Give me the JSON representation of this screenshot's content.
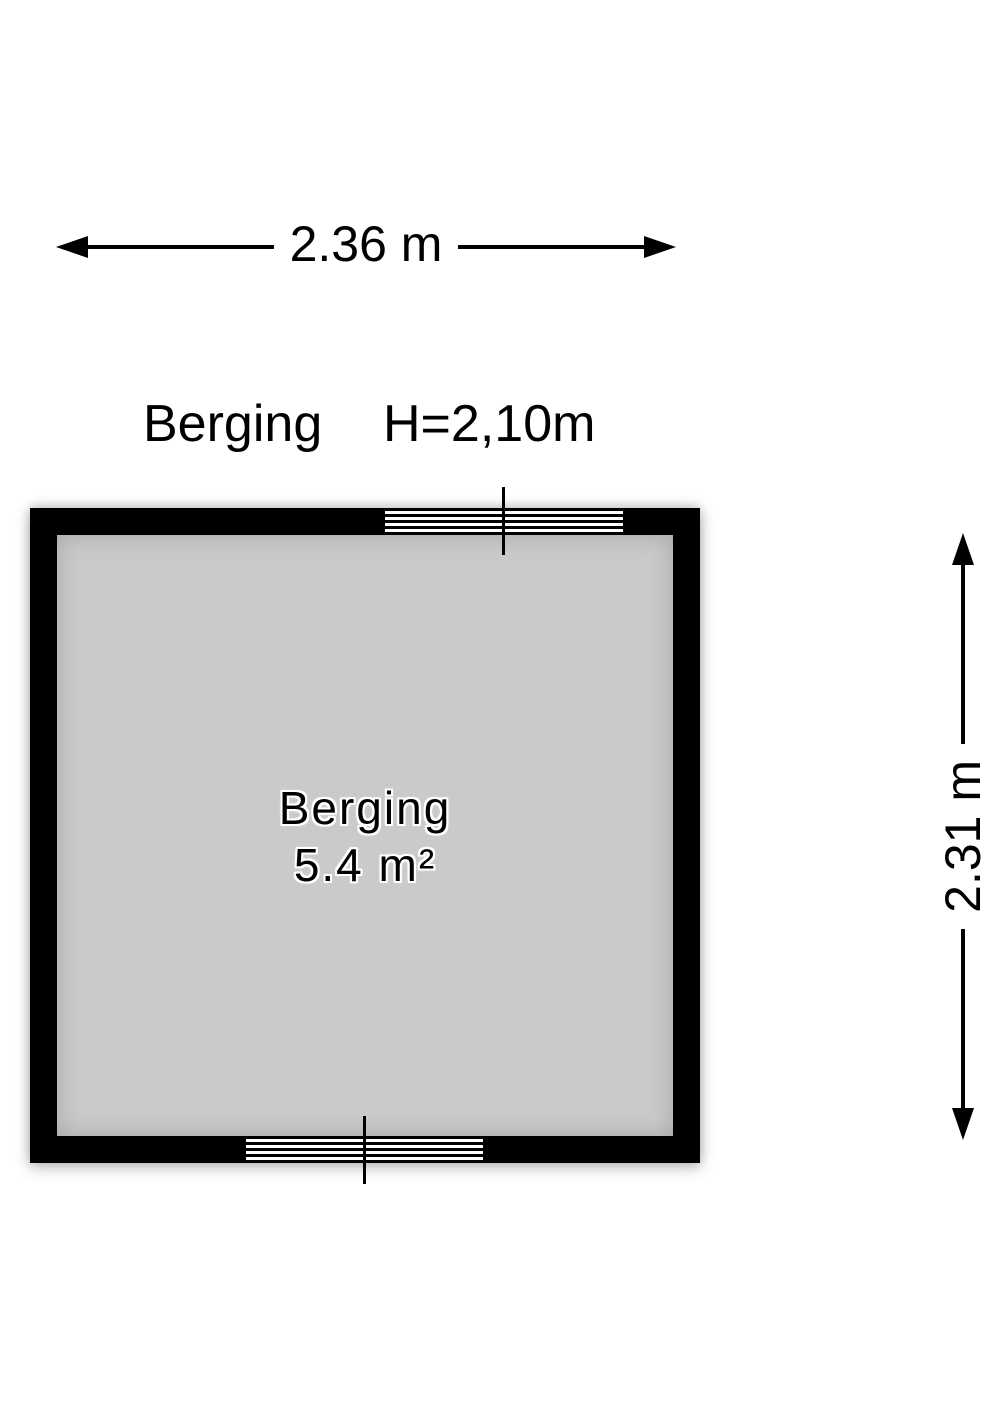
{
  "header": {
    "room_name": "Berging",
    "ceiling_height": "H=2,10m"
  },
  "dimensions": {
    "width_label": "2.36 m",
    "height_label": "2.31 m"
  },
  "room": {
    "name": "Berging",
    "area": "5.4 m²"
  },
  "icons": {
    "arrowheads": [
      "arrowhead-left-icon",
      "arrowhead-right-icon",
      "arrowhead-up-icon",
      "arrowhead-down-icon"
    ]
  },
  "colors": {
    "wall": "#000000",
    "floor": "#cacaca",
    "background": "#ffffff",
    "line": "#000000"
  }
}
